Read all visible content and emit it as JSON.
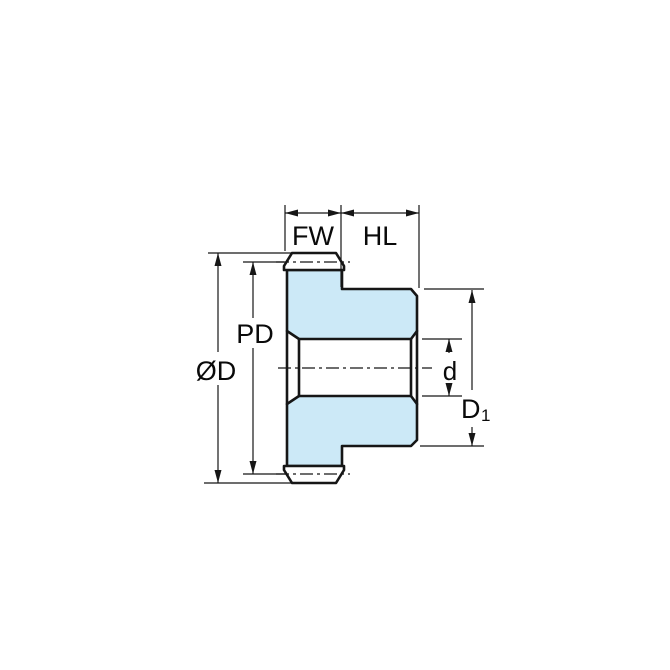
{
  "diagram": {
    "kind": "spur-gear-cross-section-dimension-drawing",
    "labels": {
      "face_width": "FW",
      "hub_length": "HL",
      "pitch_diameter": "PD",
      "outside_diameter": "ØD",
      "bore_diameter": "d",
      "hub_diameter_main": "D",
      "hub_diameter_sub": "1"
    },
    "colors": {
      "part_fill": "#cce9f7",
      "tooth_fill": "#ffffff",
      "line": "#161616",
      "text": "#0a0a0a",
      "background": "#ffffff"
    }
  }
}
